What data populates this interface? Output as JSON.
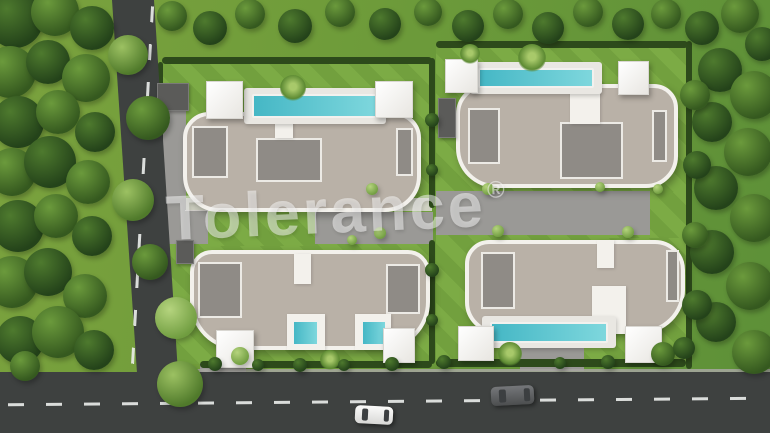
{
  "meta": {
    "description": "Aerial 3D architectural render: four modern detached villas with curved beige roofs, private turquoise pools, white pergolas, landscaped gardens, perimeter hedges, an L-shaped asphalt road with dashed lane markings, one white car and one dark car"
  },
  "watermark": {
    "text": "Tolerance",
    "registered": "®"
  },
  "colors": {
    "grass_base": "#6f9c3a",
    "lawn": "#7cab45",
    "road": "#3e4140",
    "roof": "#b9b1a7",
    "roof_trim": "#f3f1ec",
    "roof_terrace": "#8f8b86",
    "pool": "#5fc8cf",
    "hedge": "#2d4a1b",
    "pergola": "#ffffff",
    "white_car": "#f5f5f4",
    "dark_car": "#5d5f60"
  },
  "scene": {
    "lawns": [
      {
        "x": 160,
        "y": 62,
        "w": 272,
        "h": 150
      },
      {
        "x": 436,
        "y": 46,
        "w": 252,
        "h": 146
      },
      {
        "x": 160,
        "y": 244,
        "w": 272,
        "h": 120
      },
      {
        "x": 436,
        "y": 234,
        "w": 252,
        "h": 128
      },
      {
        "x": 205,
        "y": 212,
        "w": 112,
        "h": 34
      },
      {
        "x": 600,
        "y": 192,
        "w": 86,
        "h": 46
      }
    ],
    "paths": [
      {
        "x": 148,
        "y": 210,
        "w": 60,
        "h": 34
      },
      {
        "x": 315,
        "y": 212,
        "w": 118,
        "h": 32
      },
      {
        "x": 185,
        "y": 198,
        "w": 247,
        "h": 13,
        "c": "light"
      },
      {
        "x": 436,
        "y": 191,
        "w": 214,
        "h": 44
      },
      {
        "x": 200,
        "y": 363,
        "w": 46,
        "h": 11
      },
      {
        "x": 520,
        "y": 317,
        "w": 64,
        "h": 54
      },
      {
        "x": 152,
        "y": 86,
        "w": 34,
        "h": 124
      }
    ],
    "curbs": [
      {
        "x": 185,
        "y": 369,
        "w": 585,
        "h": 4
      }
    ],
    "hedges": [
      {
        "x": 162,
        "y": 57,
        "w": 270,
        "h": 7
      },
      {
        "x": 436,
        "y": 41,
        "w": 252,
        "h": 7
      },
      {
        "x": 429,
        "y": 58,
        "w": 6,
        "h": 150
      },
      {
        "x": 429,
        "y": 240,
        "w": 6,
        "h": 124
      },
      {
        "x": 686,
        "y": 41,
        "w": 6,
        "h": 328
      },
      {
        "x": 200,
        "y": 361,
        "w": 232,
        "h": 7
      },
      {
        "x": 436,
        "y": 359,
        "w": 250,
        "h": 8
      },
      {
        "x": 158,
        "y": 62,
        "w": 5,
        "h": 146
      },
      {
        "x": 158,
        "y": 250,
        "w": 5,
        "h": 112
      }
    ],
    "roads": [
      {
        "x": 105,
        "y": 0,
        "w": 80,
        "h": 373,
        "clip": "polygon(8.75% 0, 61.25% 0, 91.25% 100%, 40% 100%)",
        "n": "road-vertical"
      },
      {
        "x": 0,
        "y": 372,
        "w": 770,
        "h": 61,
        "n": "road-horizontal"
      }
    ],
    "marks": [
      {
        "x": 141,
        "y": 6,
        "w": 3,
        "h": 360,
        "rot": 3.2,
        "c": "v",
        "n": "lane-marking-vertical"
      },
      {
        "x": 8,
        "y": 400,
        "w": 756,
        "h": 3,
        "rot": -0.5,
        "c": "h",
        "n": "lane-marking-horizontal"
      }
    ],
    "buildings": [
      {
        "x": 183,
        "y": 112,
        "w": 238,
        "h": 100,
        "br": "26px 26px 36px 36px",
        "n": "villa-top-left"
      },
      {
        "x": 456,
        "y": 84,
        "w": 222,
        "h": 104,
        "br": "30px 24px 32px 40px",
        "n": "villa-top-right"
      },
      {
        "x": 190,
        "y": 250,
        "w": 240,
        "h": 100,
        "br": "22px 22px 48px 48px",
        "n": "villa-bottom-left"
      },
      {
        "x": 465,
        "y": 240,
        "w": 220,
        "h": 94,
        "br": "24px 30px 44px 32px",
        "n": "villa-bottom-right"
      }
    ],
    "patches": [
      {
        "x": 192,
        "y": 126,
        "w": 36,
        "h": 52
      },
      {
        "x": 256,
        "y": 138,
        "w": 66,
        "h": 44
      },
      {
        "x": 396,
        "y": 128,
        "w": 17,
        "h": 48
      },
      {
        "x": 468,
        "y": 108,
        "w": 32,
        "h": 56
      },
      {
        "x": 560,
        "y": 122,
        "w": 63,
        "h": 57
      },
      {
        "x": 652,
        "y": 110,
        "w": 15,
        "h": 52
      },
      {
        "x": 198,
        "y": 262,
        "w": 44,
        "h": 56
      },
      {
        "x": 386,
        "y": 264,
        "w": 34,
        "h": 50
      },
      {
        "x": 481,
        "y": 252,
        "w": 34,
        "h": 57
      },
      {
        "x": 666,
        "y": 250,
        "w": 13,
        "h": 52
      }
    ],
    "notches": [
      {
        "x": 275,
        "y": 112,
        "w": 18,
        "h": 26
      },
      {
        "x": 570,
        "y": 84,
        "w": 30,
        "h": 40
      },
      {
        "x": 287,
        "y": 314,
        "w": 38,
        "h": 36
      },
      {
        "x": 355,
        "y": 314,
        "w": 36,
        "h": 36
      },
      {
        "x": 294,
        "y": 254,
        "w": 17,
        "h": 30
      },
      {
        "x": 592,
        "y": 286,
        "w": 34,
        "h": 48
      },
      {
        "x": 597,
        "y": 240,
        "w": 17,
        "h": 28
      }
    ],
    "decks": [
      {
        "x": 244,
        "y": 88,
        "w": 142,
        "h": 36
      },
      {
        "x": 470,
        "y": 62,
        "w": 132,
        "h": 32
      },
      {
        "x": 482,
        "y": 316,
        "w": 134,
        "h": 32
      }
    ],
    "pools": [
      {
        "x": 252,
        "y": 94,
        "w": 126,
        "h": 24
      },
      {
        "x": 478,
        "y": 68,
        "w": 116,
        "h": 20
      },
      {
        "x": 490,
        "y": 322,
        "w": 118,
        "h": 21
      },
      {
        "x": 292,
        "y": 320,
        "w": 27,
        "h": 26
      },
      {
        "x": 361,
        "y": 320,
        "w": 26,
        "h": 26
      }
    ],
    "pergolas": [
      {
        "x": 206,
        "y": 81,
        "w": 37,
        "h": 38
      },
      {
        "x": 375,
        "y": 81,
        "w": 38,
        "h": 37
      },
      {
        "x": 445,
        "y": 59,
        "w": 33,
        "h": 34
      },
      {
        "x": 618,
        "y": 61,
        "w": 31,
        "h": 34
      },
      {
        "x": 216,
        "y": 330,
        "w": 38,
        "h": 38
      },
      {
        "x": 383,
        "y": 328,
        "w": 32,
        "h": 35
      },
      {
        "x": 458,
        "y": 326,
        "w": 36,
        "h": 35
      },
      {
        "x": 625,
        "y": 326,
        "w": 37,
        "h": 37
      }
    ],
    "garages": [
      {
        "x": 157,
        "y": 83,
        "w": 32,
        "h": 28
      },
      {
        "x": 176,
        "y": 240,
        "w": 18,
        "h": 24
      },
      {
        "x": 438,
        "y": 98,
        "w": 18,
        "h": 40
      }
    ],
    "cars": [
      {
        "x": 355,
        "y": 406,
        "w": 38,
        "h": 18,
        "rot": 3,
        "c": "white",
        "n": "white-car"
      },
      {
        "x": 491,
        "y": 386,
        "w": 43,
        "h": 19,
        "rot": -3,
        "c": "dark",
        "n": "dark-car"
      }
    ],
    "trees": [
      [
        15,
        20,
        28,
        "d"
      ],
      [
        55,
        12,
        24,
        "m"
      ],
      [
        92,
        28,
        22,
        "d"
      ],
      [
        10,
        72,
        26,
        "m"
      ],
      [
        48,
        62,
        22,
        "d"
      ],
      [
        86,
        78,
        24,
        "m"
      ],
      [
        18,
        122,
        26,
        "d"
      ],
      [
        58,
        112,
        22,
        "m"
      ],
      [
        95,
        132,
        20,
        "d"
      ],
      [
        12,
        172,
        24,
        "m"
      ],
      [
        50,
        162,
        26,
        "d"
      ],
      [
        88,
        182,
        22,
        "m"
      ],
      [
        18,
        226,
        26,
        "d"
      ],
      [
        56,
        216,
        22,
        "m"
      ],
      [
        92,
        236,
        20,
        "d"
      ],
      [
        12,
        282,
        26,
        "m"
      ],
      [
        48,
        272,
        24,
        "d"
      ],
      [
        85,
        296,
        22,
        "m"
      ],
      [
        20,
        340,
        24,
        "d"
      ],
      [
        58,
        332,
        26,
        "m"
      ],
      [
        94,
        350,
        20,
        "d"
      ],
      [
        25,
        366,
        15,
        "m"
      ],
      [
        128,
        55,
        20,
        "l"
      ],
      [
        148,
        118,
        22,
        "m"
      ],
      [
        133,
        200,
        21,
        "l"
      ],
      [
        150,
        262,
        18,
        "m"
      ],
      [
        176,
        318,
        21,
        "p"
      ],
      [
        180,
        384,
        23,
        "l"
      ],
      [
        172,
        16,
        15,
        "m"
      ],
      [
        210,
        28,
        17,
        "d"
      ],
      [
        250,
        14,
        15,
        "m"
      ],
      [
        295,
        26,
        17,
        "d"
      ],
      [
        340,
        12,
        15,
        "m"
      ],
      [
        385,
        24,
        16,
        "d"
      ],
      [
        428,
        12,
        14,
        "m"
      ],
      [
        468,
        26,
        16,
        "d"
      ],
      [
        508,
        14,
        15,
        "m"
      ],
      [
        548,
        28,
        16,
        "d"
      ],
      [
        588,
        12,
        15,
        "m"
      ],
      [
        628,
        24,
        16,
        "d"
      ],
      [
        666,
        14,
        15,
        "m"
      ],
      [
        702,
        28,
        17,
        "d"
      ],
      [
        740,
        14,
        19,
        "m"
      ],
      [
        762,
        44,
        17,
        "d"
      ],
      [
        720,
        70,
        22,
        "d"
      ],
      [
        754,
        95,
        24,
        "m"
      ],
      [
        712,
        122,
        20,
        "d"
      ],
      [
        748,
        152,
        24,
        "m"
      ],
      [
        716,
        188,
        22,
        "d"
      ],
      [
        754,
        218,
        24,
        "m"
      ],
      [
        712,
        252,
        22,
        "d"
      ],
      [
        750,
        286,
        24,
        "m"
      ],
      [
        716,
        322,
        20,
        "d"
      ],
      [
        754,
        352,
        22,
        "m"
      ],
      [
        695,
        95,
        15,
        "m"
      ],
      [
        697,
        165,
        14,
        "d"
      ],
      [
        695,
        235,
        13,
        "m"
      ],
      [
        697,
        305,
        15,
        "d"
      ],
      [
        293,
        88,
        13,
        "palm"
      ],
      [
        532,
        58,
        14,
        "palm"
      ],
      [
        470,
        54,
        10,
        "palm"
      ],
      [
        510,
        354,
        12,
        "palm"
      ],
      [
        330,
        360,
        10,
        "palm"
      ],
      [
        240,
        356,
        9,
        "p"
      ],
      [
        663,
        354,
        12,
        "m"
      ],
      [
        684,
        348,
        11,
        "d"
      ],
      [
        372,
        189,
        6,
        "p"
      ],
      [
        380,
        233,
        6,
        "p"
      ],
      [
        488,
        189,
        6,
        "p"
      ],
      [
        498,
        231,
        6,
        "p"
      ],
      [
        600,
        187,
        5,
        "p"
      ],
      [
        628,
        232,
        6,
        "p"
      ],
      [
        658,
        189,
        5,
        "p"
      ],
      [
        352,
        240,
        5,
        "p"
      ],
      [
        215,
        364,
        7,
        "d"
      ],
      [
        258,
        365,
        6,
        "d"
      ],
      [
        300,
        365,
        7,
        "d"
      ],
      [
        344,
        365,
        6,
        "d"
      ],
      [
        392,
        364,
        7,
        "d"
      ],
      [
        444,
        362,
        7,
        "d"
      ],
      [
        560,
        363,
        6,
        "d"
      ],
      [
        608,
        362,
        7,
        "d"
      ],
      [
        432,
        120,
        7,
        "d"
      ],
      [
        432,
        170,
        6,
        "d"
      ],
      [
        432,
        270,
        7,
        "d"
      ],
      [
        432,
        320,
        6,
        "d"
      ]
    ]
  }
}
